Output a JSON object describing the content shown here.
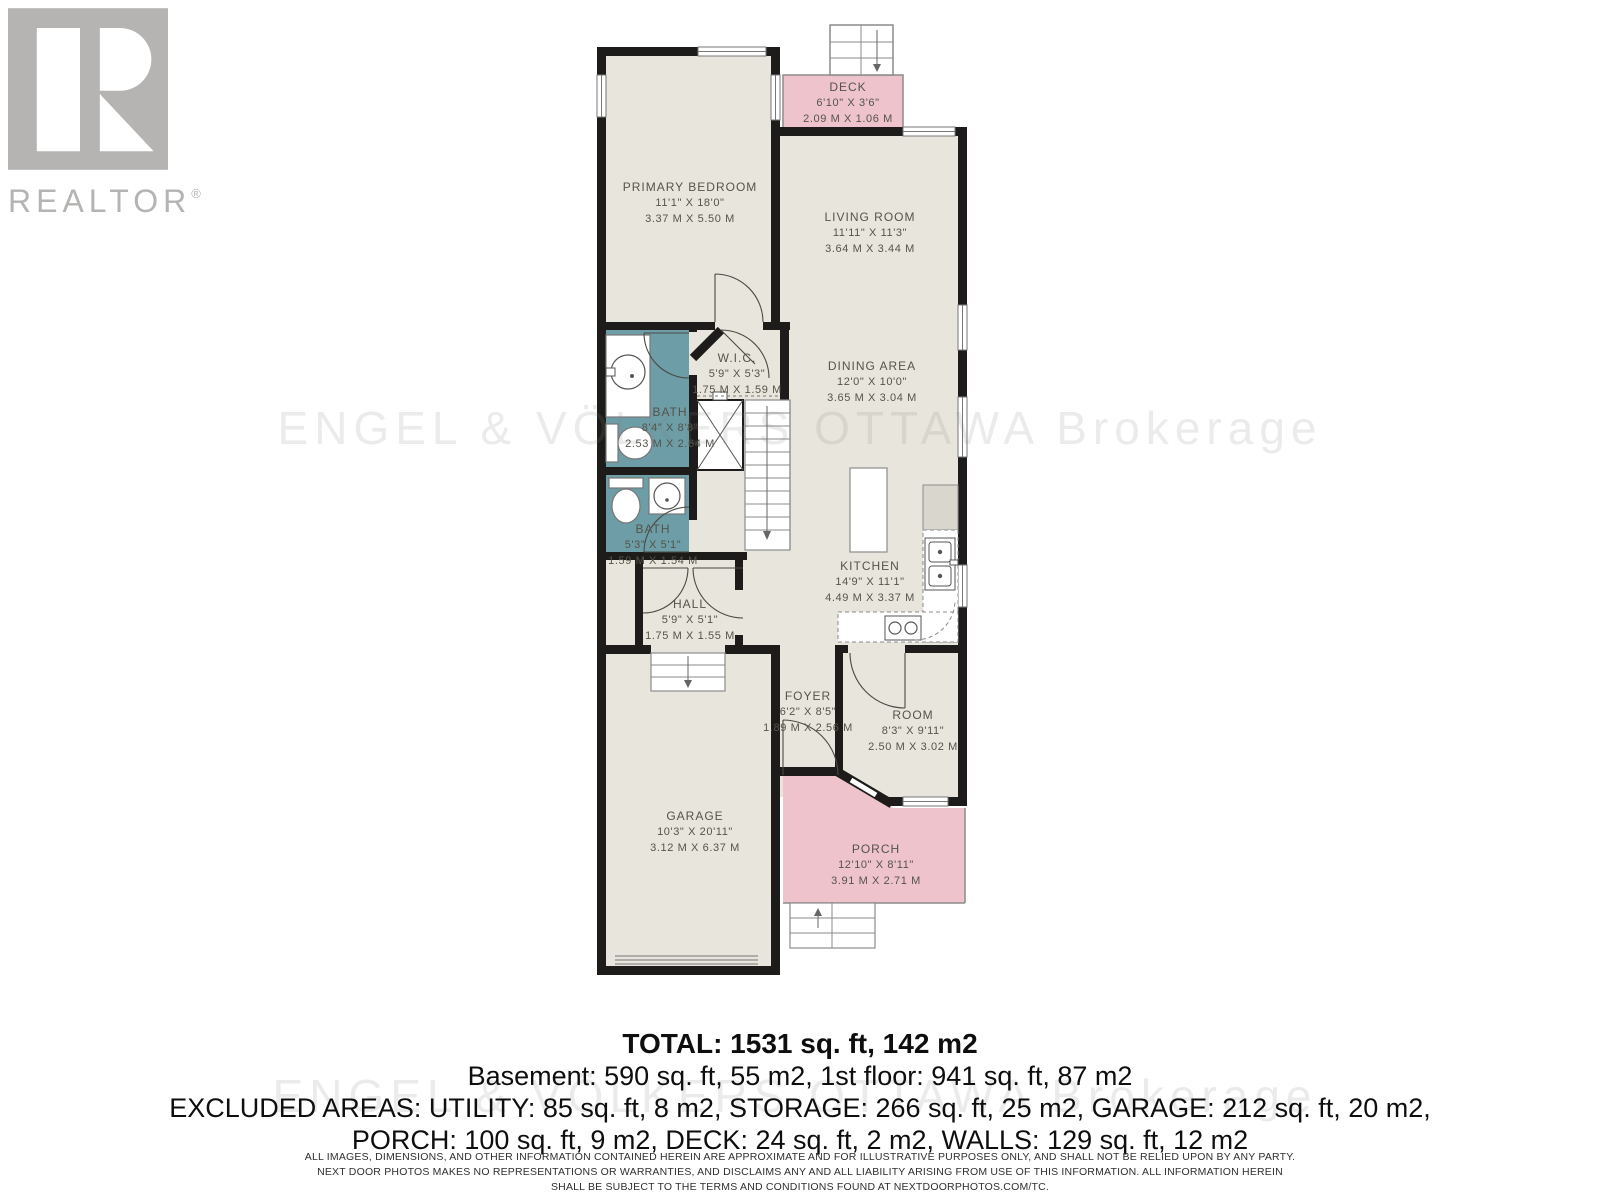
{
  "logo": {
    "brand": "REALTOR",
    "registered": "®"
  },
  "watermark": {
    "text": "ENGEL & VÖLKERS OTTAWA Brokerage"
  },
  "floorplan": {
    "colors": {
      "room_fill": "#e8e6dc",
      "outdoor_pink": "#eec3cb",
      "bath_teal": "#6d9da6",
      "wall_black": "#1d1c1a"
    },
    "rooms": [
      {
        "id": "primary-bedroom",
        "name": "PRIMARY BEDROOM",
        "imperial": "11'1\" X 18'0\"",
        "metric": "3.37 M X 5.50 M"
      },
      {
        "id": "deck",
        "name": "DECK",
        "imperial": "6'10\" X 3'6\"",
        "metric": "2.09 M X 1.06 M"
      },
      {
        "id": "living-room",
        "name": "LIVING ROOM",
        "imperial": "11'11\" X 11'3\"",
        "metric": "3.64 M X 3.44 M"
      },
      {
        "id": "dining-area",
        "name": "DINING AREA",
        "imperial": "12'0\" X 10'0\"",
        "metric": "3.65 M X 3.04 M"
      },
      {
        "id": "wic",
        "name": "W.I.C.",
        "imperial": "5'9\" X 5'3\"",
        "metric": "1.75 M X 1.59 M"
      },
      {
        "id": "bath-main",
        "name": "BATH",
        "imperial": "8'4\" X 8'8\"",
        "metric": "2.53 M X 2.64 M"
      },
      {
        "id": "bath-small",
        "name": "BATH",
        "imperial": "5'3\" X 5'1\"",
        "metric": "1.59 M X 1.54 M"
      },
      {
        "id": "hall",
        "name": "HALL",
        "imperial": "5'9\" X 5'1\"",
        "metric": "1.75 M X 1.55 M"
      },
      {
        "id": "kitchen",
        "name": "KITCHEN",
        "imperial": "14'9\" X 11'1\"",
        "metric": "4.49 M X 3.37 M"
      },
      {
        "id": "foyer",
        "name": "FOYER",
        "imperial": "6'2\" X 8'5\"",
        "metric": "1.89 M X 2.56 M"
      },
      {
        "id": "room",
        "name": "ROOM",
        "imperial": "8'3\" X 9'11\"",
        "metric": "2.50 M X 3.02 M"
      },
      {
        "id": "garage",
        "name": "GARAGE",
        "imperial": "10'3\" X 20'11\"",
        "metric": "3.12 M X 6.37 M"
      },
      {
        "id": "porch",
        "name": "PORCH",
        "imperial": "12'10\" X 8'11\"",
        "metric": "3.91 M X 2.71 M"
      }
    ]
  },
  "summary": {
    "total": "TOTAL: 1531 sq. ft, 142 m2",
    "floors": "Basement: 590 sq. ft, 55 m2, 1st floor: 941 sq. ft, 87 m2",
    "excluded1": "EXCLUDED AREAS: UTILITY: 85 sq. ft, 8 m2, STORAGE: 266 sq. ft, 25 m2, GARAGE: 212 sq. ft, 20 m2,",
    "excluded2": "PORCH: 100 sq. ft, 9 m2, DECK: 24 sq. ft, 2 m2, WALLS: 129 sq. ft, 12 m2"
  },
  "disclaimer": {
    "line1": "ALL IMAGES, DIMENSIONS, AND OTHER INFORMATION CONTAINED HEREIN ARE APPROXIMATE AND FOR ILLUSTRATIVE PURPOSES ONLY, AND SHALL NOT BE RELIED UPON BY ANY PARTY.",
    "line2": "NEXT DOOR PHOTOS MAKES NO REPRESENTATIONS OR WARRANTIES, AND DISCLAIMS ANY AND ALL LIABILITY ARISING FROM USE OF THIS INFORMATION. ALL INFORMATION HEREIN",
    "line3": "SHALL BE SUBJECT TO THE TERMS AND CONDITIONS FOUND AT NEXTDOORPHOTOS.COM/TC."
  }
}
